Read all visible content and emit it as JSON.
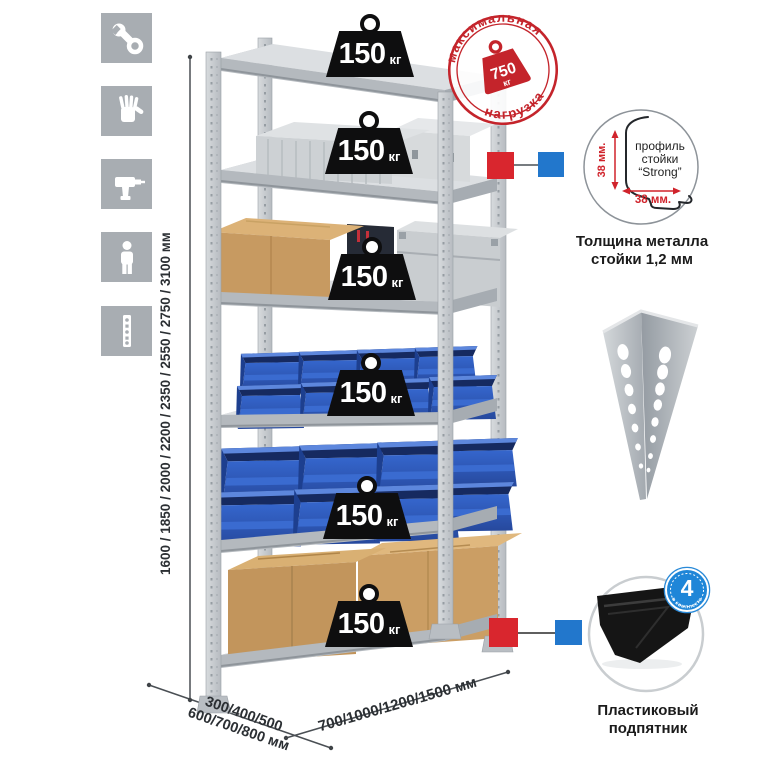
{
  "shelf_weight": {
    "value": "150",
    "unit": "кг"
  },
  "stamp": {
    "arc_top": "максимальная",
    "arc_bottom": "нагрузка",
    "value": "750",
    "unit": "кг"
  },
  "height_dimension": "1600 / 1850 / 2000 / 2200 / 2350 / 2550 / 2750 / 3100 мм",
  "depth_dimension": {
    "line1": "300/400/500",
    "line2": "600/700/800 мм"
  },
  "width_dimension": "700/1000/1200/1500 мм",
  "profile_callout": {
    "line1": "профиль",
    "line2": "стойки",
    "line3": "“Strong”",
    "dim_vertical": "38 мм.",
    "dim_horizontal": "38 мм.",
    "caption1": "Толщина металла",
    "caption2": "стойки 1,2 мм"
  },
  "foot_callout": {
    "badge_value": "4",
    "badge_arc": "в комплекте",
    "caption1": "Пластиковый",
    "caption2": "подпятник"
  },
  "sidebar_icons": [
    "wrench-icon",
    "gloves-icon",
    "drill-icon",
    "person-icon",
    "rack-post-icon"
  ],
  "colors": {
    "accent_red": "#d0232b",
    "accent_blue": "#2277cc",
    "bin_blue": "#2f5fc2",
    "cardboard": "#c79b63"
  }
}
